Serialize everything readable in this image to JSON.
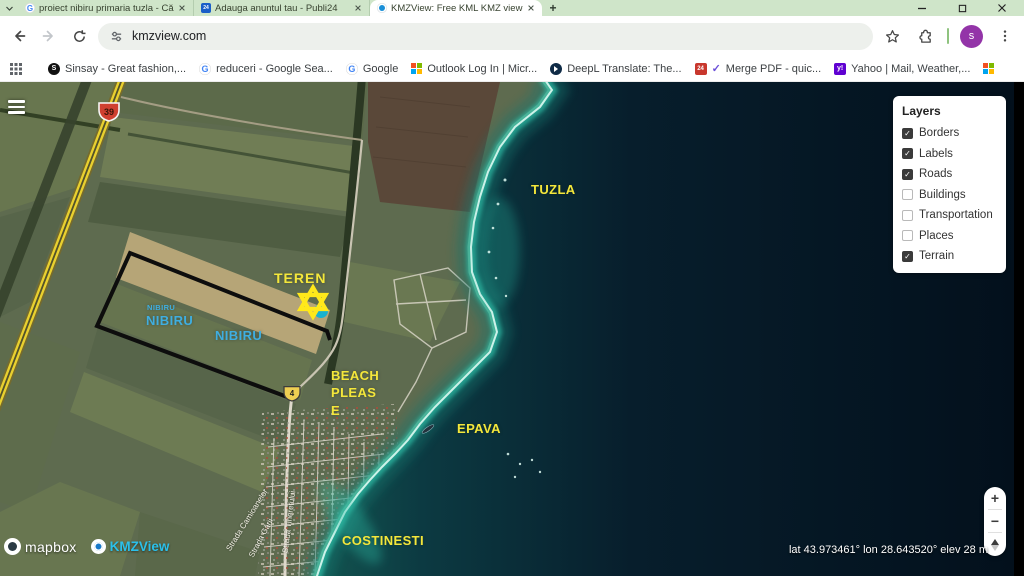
{
  "browser": {
    "tabs": [
      {
        "title": "proiect nibiru primaria tuzla - Cău",
        "active": false
      },
      {
        "title": "Adauga anuntul tau - Publi24",
        "active": false
      },
      {
        "title": "KMZView: Free KML KMZ viewer",
        "active": true
      }
    ],
    "new_tab_label": "+",
    "address_url": "kmzview.com",
    "profile_initial": "s",
    "icon_glyphs": {
      "google": "G",
      "sinsay": "S",
      "yahoo": "y!",
      "publi24": "24",
      "pdf24": "24",
      "check": "✓"
    },
    "bookmarks": {
      "items": [
        {
          "label": "Sinsay - Great fashion,..."
        },
        {
          "label": "reduceri - Google Sea..."
        },
        {
          "label": "Google"
        },
        {
          "label": "Outlook Log In | Micr..."
        },
        {
          "label": "DeepL Translate: The..."
        },
        {
          "label": "Merge PDF - quic..."
        },
        {
          "label": "Yahoo | Mail, Weather,..."
        },
        {
          "label": ""
        }
      ],
      "overflow": "»",
      "all_bookmarks": "All Bookmarks"
    }
  },
  "map": {
    "layers_panel": {
      "title": "Layers",
      "items": [
        {
          "label": "Borders",
          "checked": true
        },
        {
          "label": "Labels",
          "checked": true
        },
        {
          "label": "Roads",
          "checked": true
        },
        {
          "label": "Buildings",
          "checked": false
        },
        {
          "label": "Transportation",
          "checked": false
        },
        {
          "label": "Places",
          "checked": false
        },
        {
          "label": "Terrain",
          "checked": true
        }
      ]
    },
    "labels": {
      "tuzla": "TUZLA",
      "teren": "TEREN",
      "nibiru_small": "NIBIRU",
      "nibiru_left": "NIBIRU",
      "nibiru_right": "NIBIRU",
      "beach_line1": "BEACH",
      "beach_line2": "PLEAS",
      "beach_line3": "E",
      "epava": "EPAVA",
      "costinesti": "COSTINESTI",
      "street_camioanelor": "Strada Camioanelor",
      "street_garii": "Strada Gării",
      "street_tineretului": "Strada Tineretului"
    },
    "road_shields": {
      "national": "39",
      "local": "4"
    },
    "zoom_controls": {
      "zoom_in": "+",
      "zoom_out": "−"
    },
    "status": "lat 43.973461° lon 28.643520° elev 28 m",
    "attribution": {
      "mapbox": "mapbox",
      "kmzview": "KMZView"
    },
    "colors": {
      "label_yellow": "#F4E73B",
      "label_cyan": "#3FAEE0",
      "star_yellow": "#FFE81A",
      "sea_dark": "#071E2C"
    }
  }
}
